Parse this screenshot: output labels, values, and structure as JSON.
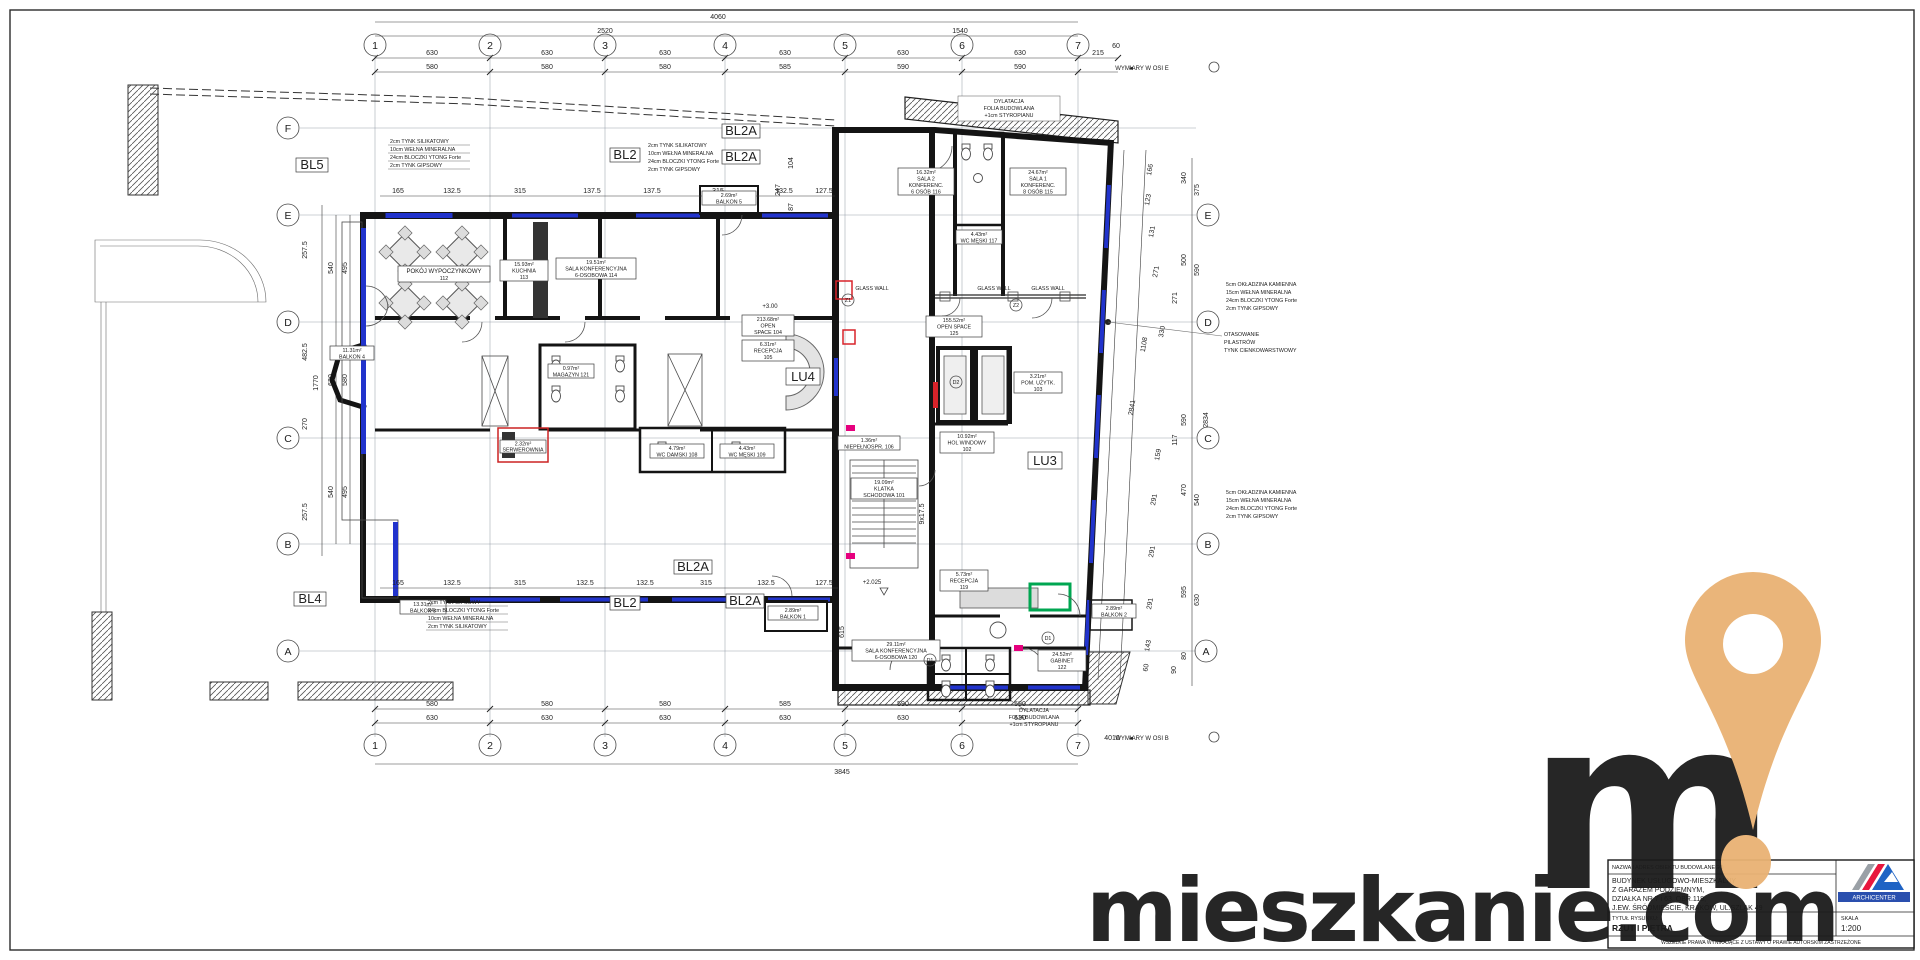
{
  "axes": {
    "cols": [
      "1",
      "2",
      "3",
      "4",
      "5",
      "6",
      "7"
    ],
    "rows_left": [
      "F",
      "E",
      "D",
      "C",
      "B",
      "A"
    ],
    "rows_right": [
      "E",
      "D",
      "C",
      "B",
      "A"
    ]
  },
  "dims": {
    "top": {
      "total": "4060",
      "span_left": "2520",
      "span_right": "1540",
      "row630": [
        "630",
        "630",
        "630",
        "630",
        "630",
        "630"
      ],
      "v215": "215",
      "v60": "60",
      "row580": [
        "580",
        "580",
        "580",
        "585",
        "590",
        "590"
      ]
    },
    "bottom": {
      "total": "3845",
      "row630": [
        "630",
        "630",
        "630",
        "630",
        "630",
        "630"
      ],
      "row580": [
        "580",
        "580",
        "580",
        "585",
        "590",
        "590"
      ]
    },
    "left": {
      "total": "1770",
      "outer": [
        "540",
        "630",
        "540"
      ],
      "inner": [
        "495",
        "580",
        "495"
      ],
      "extras": [
        "257.5",
        "482.5",
        "270",
        "257.5"
      ]
    },
    "right": {
      "inner": [
        "166",
        "123",
        "131",
        "271",
        "330",
        "1108",
        "159",
        "291",
        "291",
        "291",
        "143",
        "60"
      ],
      "outer": [
        "340",
        "375",
        "500",
        "590",
        "271",
        "590",
        "117",
        "470",
        "540",
        "595",
        "630",
        "80",
        "90"
      ],
      "slant": "2841",
      "slant2": "2834"
    },
    "inner_top": [
      "165",
      "132.5",
      "315",
      "137.5",
      "137.5",
      "315",
      "132.5",
      "127.5"
    ],
    "inner_bottom": [
      "165",
      "132.5",
      "315",
      "132.5",
      "132.5",
      "315",
      "132.5",
      "127.5"
    ],
    "misc": {
      "v104": "104",
      "v247": "247",
      "v87": "87",
      "v615": "615",
      "stair": "9x17.5",
      "v4010": "4010"
    }
  },
  "levels": {
    "p300": "+3.00",
    "p2025": "+2.025"
  },
  "marks": {
    "z1": "Z1",
    "z2": "Z2",
    "d1": "D1",
    "d2": "D2",
    "glass": "GLASS WALL"
  },
  "bl": {
    "bl5": "BL5",
    "bl2t": "BL2",
    "bl2a1": "BL2A",
    "bl2a2": "BL2A",
    "bl4": "BL4",
    "bl2b": "BL2",
    "bl2a3": "BL2A",
    "bl2a4": "BL2A"
  },
  "lu": {
    "lu4": "LU4",
    "lu3": "LU3"
  },
  "wymiary": {
    "arrow": "◄",
    "osi_e": "WYMIARY W OSI E",
    "osi_b": "WYMIARY W OSI B"
  },
  "notes": {
    "wall_top": [
      "2cm  TYNK SILIKATOWY",
      "10cm  WEŁNA MINERALNA",
      "24cm  BLOCZKI YTONG Forte",
      "2cm  TYNK GIPSOWY"
    ],
    "wall_bottom": [
      "2cm  TYNK GIPSOWY",
      "24cm  BLOCZKI YTONG Forte",
      "10cm  WEŁNA MINERALNA",
      "2cm  TYNK SILIKATOWY"
    ],
    "wall_right": [
      "5cm  OKŁADZINA KAMIENNA",
      "15cm  WEŁNA MINERALNA",
      "24cm  BLOCZKI YTONG Forte",
      "2cm  TYNK GIPSOWY"
    ],
    "pilasters": [
      "OTASOWANIE",
      "PILASTRÓW",
      "TYNK CIENKOWARSTWOWY"
    ],
    "dylatacja": [
      "DYLATACJA",
      "FOLIA BUDOWLANA",
      "+1cm STYROPIANU"
    ]
  },
  "rooms": {
    "r101": {
      "area": "19.09m²",
      "l1": "KLATKA",
      "l2": "SCHODOWA 101"
    },
    "r102": {
      "area": "10.92m²",
      "l1": "HOL WINDOWY",
      "l2": "102"
    },
    "r103": {
      "area": "3.21m²",
      "l1": "POM. UŻYTK.",
      "l2": "103"
    },
    "r104": {
      "area": "213.68m²",
      "l1": "OPEN",
      "l2": "SPACE 104"
    },
    "r105": {
      "area": "6.31m²",
      "l1": "RECEPCJA",
      "l2": "105"
    },
    "r106": {
      "area": "1.36m²",
      "l1": "WC",
      "l2": "NIEPEŁNOSPR. 106"
    },
    "r108": {
      "area": "4.79m²",
      "l1": "WC DAMSKI 108"
    },
    "r109": {
      "area": "4.43m²",
      "l1": "WC MĘSKI 109"
    },
    "r112": {
      "l1": "POKÓJ WYPOCZYNKOWY",
      "l2": "112"
    },
    "r113": {
      "area": "15.93m²",
      "l1": "KUCHNIA",
      "l2": "113"
    },
    "r114": {
      "area": "19.51m²",
      "l1": "SALA KONFERENCYJNA",
      "l2": "6-OSOBOWA 114"
    },
    "r115": {
      "area": "24.67m²",
      "l1": "SALA 1",
      "l2": "KONFERENC.",
      "l3": "8 OSÓB 115"
    },
    "r116": {
      "area": "16.32m²",
      "l1": "SALA 2",
      "l2": "KONFERENC.",
      "l3": "6 OSÓB 116"
    },
    "r117": {
      "area": "4.43m²",
      "l1": "WC MĘSKI 117"
    },
    "r119": {
      "area": "5.73m²",
      "l1": "RECEPCJA",
      "l2": "119"
    },
    "r120": {
      "area": "29.11m²",
      "l1": "SALA KONFERENCYJNA",
      "l2": "6-OSOBOWA 120"
    },
    "r121": {
      "area": "0.97m²",
      "l1": "MAGAZYN 121"
    },
    "r122": {
      "area": "24.52m²",
      "l1": "GABINET",
      "l2": "122"
    },
    "r125": {
      "area": "155.52m²",
      "l1": "OPEN SPACE",
      "l2": "125"
    },
    "serw": {
      "area": "2.32m²",
      "l1": "SERWEROWNIA"
    },
    "b1": {
      "area": "2.89m²",
      "l1": "BALKON 1"
    },
    "b2": {
      "area": "2.89m²",
      "l1": "BALKON 2"
    },
    "b3": {
      "area": "13.31m²",
      "l1": "BALKON 3"
    },
    "b4": {
      "area": "11.31m²",
      "l1": "BALKON 4"
    },
    "b5": {
      "area": "2.69m²",
      "l1": "BALKON 5"
    }
  },
  "titleblock": {
    "label_object": "NAZWA I ADRES OBIEKTU BUDOWLANEGO",
    "obj1": "BUDYNEK USŁUGOWO-MIESZKALNY",
    "obj2": "Z GARAŻEM PODZIEMNYM,",
    "obj3": "DZIAŁKA NR 7 i 63, OBR.118,",
    "obj4": "J.EW. ŚRÓDMIEŚCIE, KRAKÓW, UL.SZLAK 49",
    "label_title": "TYTUŁ RYSUNKU:",
    "title": "RZUT I PIĘTRA",
    "label_scale": "SKALA",
    "scale": "1:200",
    "firm": "ARCHICENTER",
    "footer": "WSZELKIE PRAWA WYNIKAJĄCE Z USTAWY O PRAWIE AUTORSKIM ZASTRZEŻONE"
  },
  "watermark": {
    "m": "m",
    "domain": "mieszkanie.com"
  },
  "colors": {
    "navy": "#2e3156",
    "orange": "#e9b273",
    "window": "#2133cc",
    "magenta": "#e6007e",
    "red": "#d8232a",
    "green": "#00a651"
  }
}
